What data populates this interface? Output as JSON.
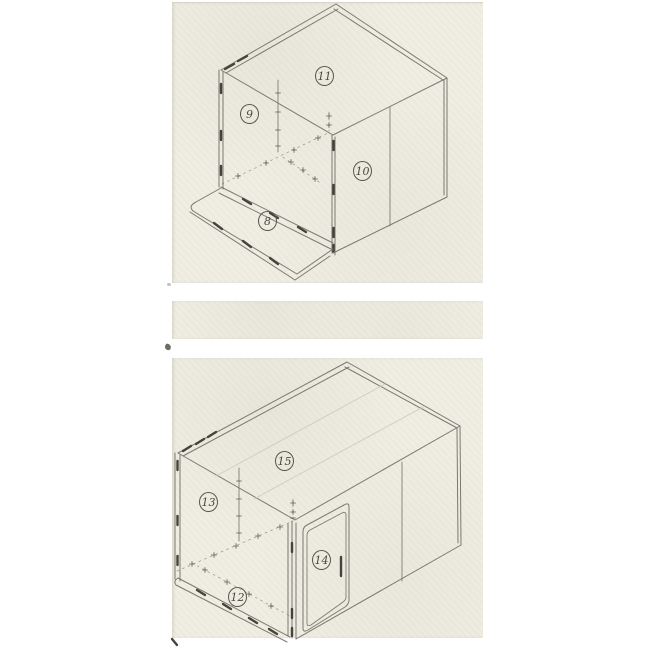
{
  "document": {
    "kind": "scanned-assembly-diagram",
    "figure_count": 2
  },
  "colors": {
    "scan_bg": "#f0eee3",
    "line": "#7a7870",
    "line_dark": "#45433b",
    "line_faint": "#cfccc0",
    "label_ink": "#4a4840",
    "circle_ink": "#57554c"
  },
  "figures": [
    {
      "name": "upper-assembly-view",
      "labels": [
        {
          "number": "8"
        },
        {
          "number": "9"
        },
        {
          "number": "10"
        },
        {
          "number": "11"
        }
      ]
    },
    {
      "name": "lower-assembly-view",
      "labels": [
        {
          "number": "12"
        },
        {
          "number": "13"
        },
        {
          "number": "14"
        },
        {
          "number": "15"
        }
      ]
    }
  ]
}
